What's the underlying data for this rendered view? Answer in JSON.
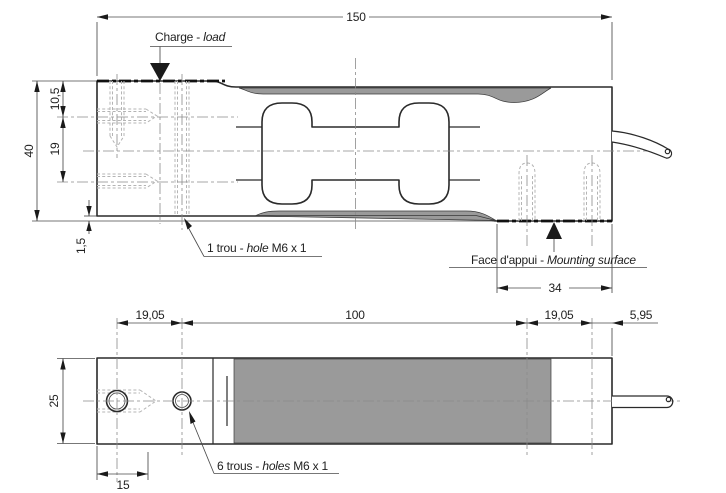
{
  "side_view": {
    "dim_length": "150",
    "dim_height": "40",
    "dim_top_hole": "10,5",
    "dim_hole_spacing": "19",
    "dim_lip": "1,5",
    "dim_mounting_len": "34",
    "charge": {
      "fr": "Charge - ",
      "en": "load"
    },
    "hole1": {
      "fr": "1 trou - ",
      "en": "hole",
      "spec": " M6 x 1"
    },
    "mounting": {
      "fr": "Face d'appui - ",
      "en": "Mounting surface"
    }
  },
  "plan_view": {
    "dim_pitch_left": "19,05",
    "dim_center": "100",
    "dim_pitch_right": "19,05",
    "dim_end": "5,95",
    "dim_width": "25",
    "dim_offset": "15",
    "holes6": {
      "fr": "6 trous - ",
      "en": "holes",
      "spec": " M6 x 1"
    }
  },
  "colors": {
    "outline": "#2a2a2a",
    "gray_fill": "#9a9a9a",
    "hidden_line": "#b4b4b4",
    "centerline": "#8a8a8a",
    "dimension": "#4a4a4a",
    "text": "#1f1f1f",
    "background": "#ffffff"
  }
}
